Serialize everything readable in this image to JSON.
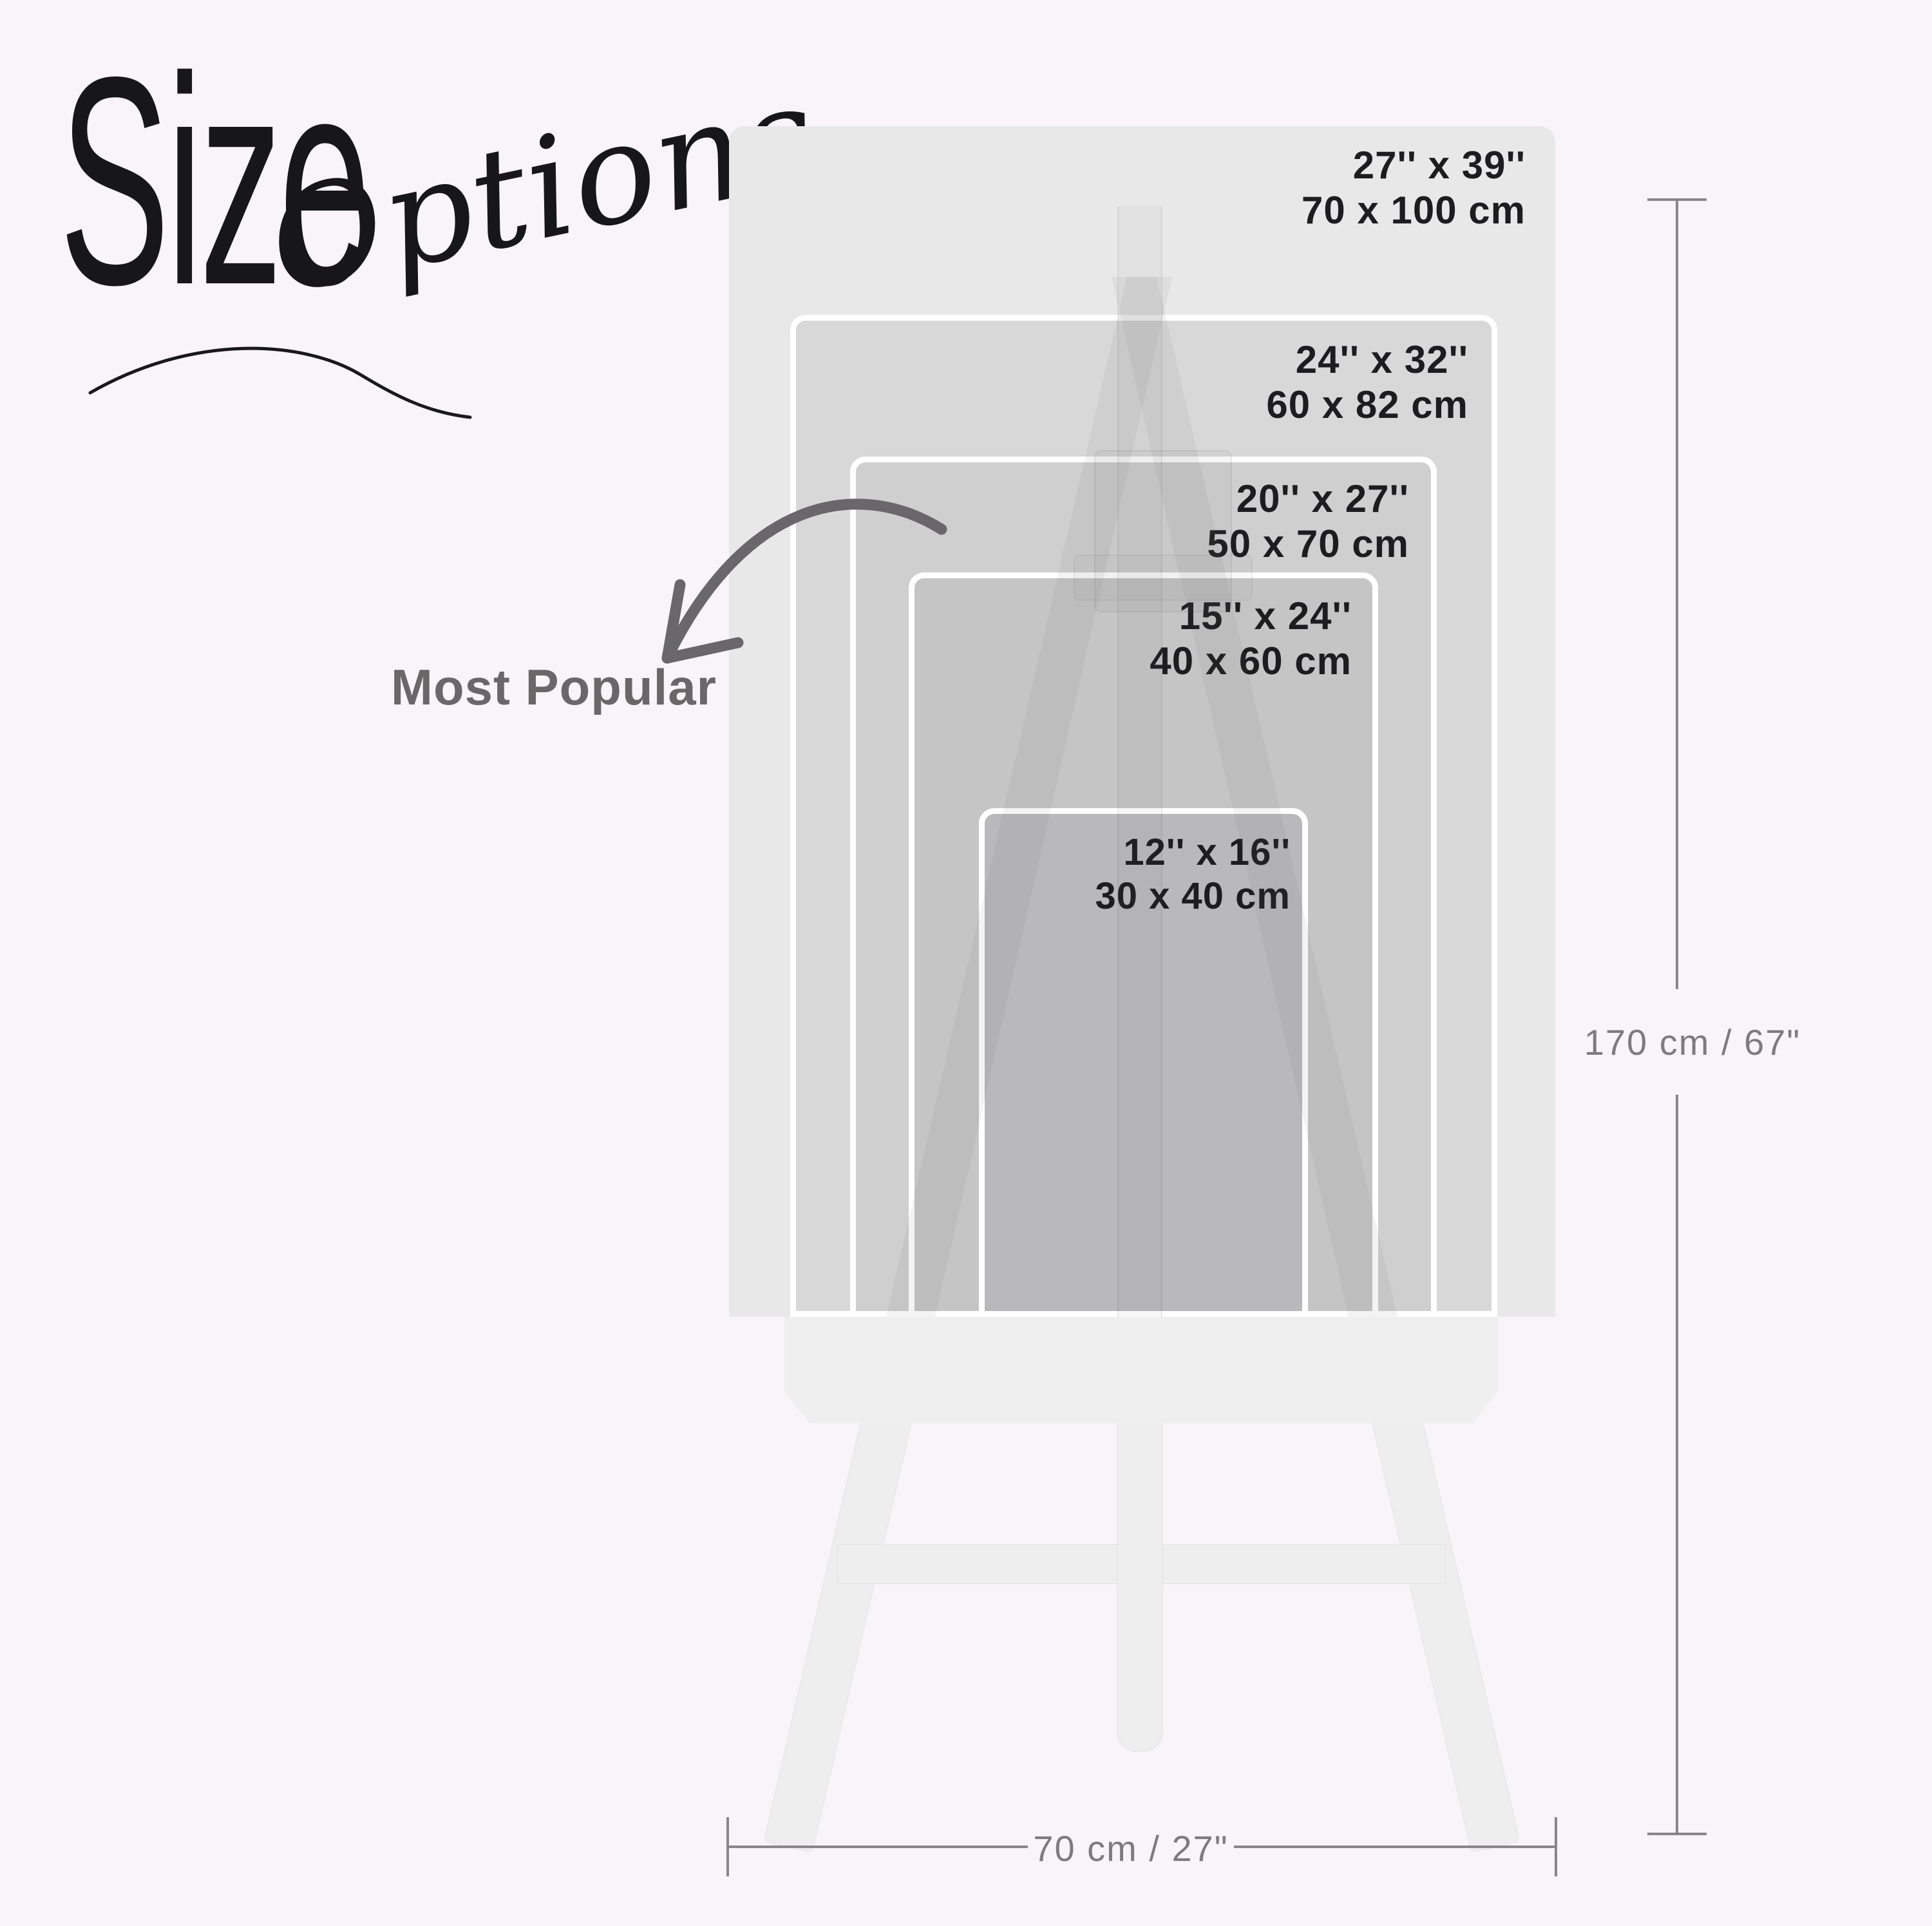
{
  "title": {
    "size": "Size",
    "options": "Options"
  },
  "most_popular": "Most Popular",
  "sizes": [
    {
      "id": "27x39",
      "inches": "27'' x 39''",
      "cm": "70 x 100 cm"
    },
    {
      "id": "24x32",
      "inches": "24'' x 32''",
      "cm": "60 x 82 cm"
    },
    {
      "id": "20x27",
      "inches": "20'' x 27''",
      "cm": "50 x 70 cm"
    },
    {
      "id": "15x24",
      "inches": "15'' x 24''",
      "cm": "40 x 60 cm"
    },
    {
      "id": "12x16",
      "inches": "12'' x 16''",
      "cm": "30 x 40 cm"
    }
  ],
  "dimensions": {
    "height_label": "170 cm / 67\"",
    "width_label": "70 cm / 27\""
  },
  "colors": {
    "background": "#f9f4f7",
    "poster_shades": [
      "#e9e8e9",
      "#d9d8d9",
      "#d0cfd0",
      "#c6c5c6",
      "#b9b8ba"
    ],
    "easel": "#efeeef",
    "label_text": "#1d1d1f",
    "dimension_line": "#8a8589",
    "dimension_text": "#7e7a7d",
    "arrow": "#6a676a",
    "title_text": "#17171a"
  }
}
